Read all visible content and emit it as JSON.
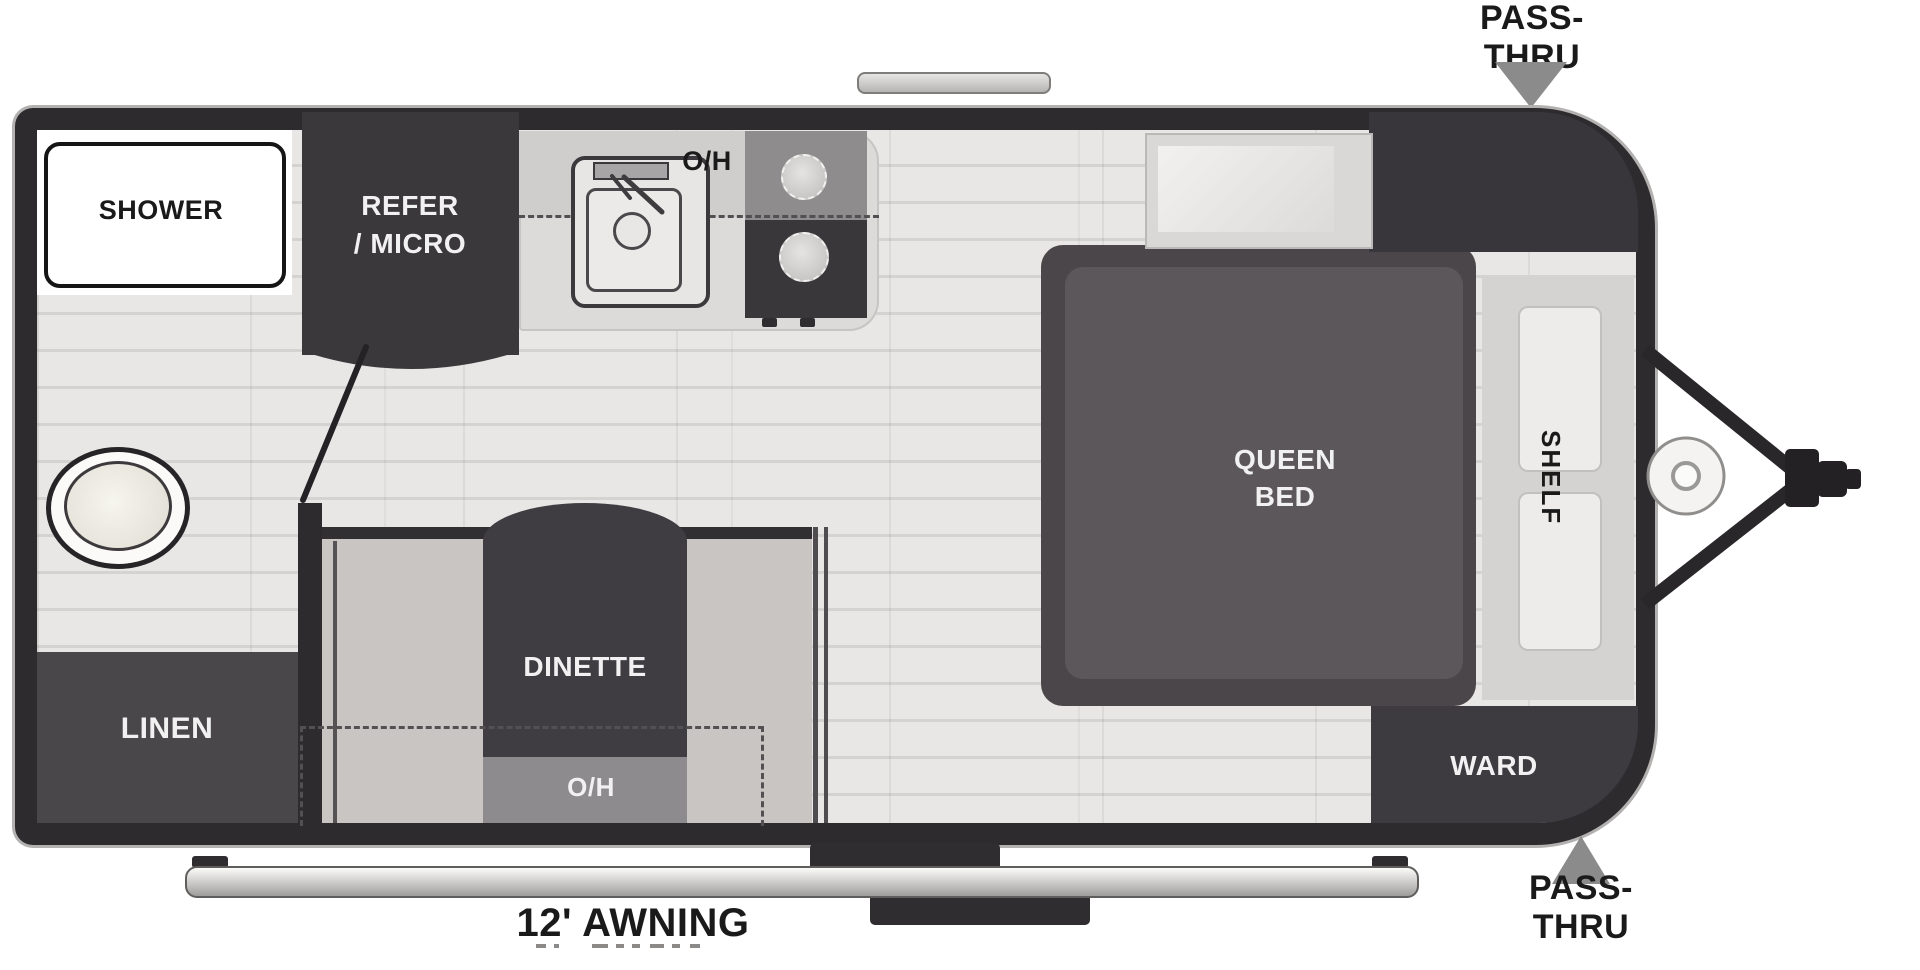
{
  "title": "Travel trailer floor plan",
  "exterior": {
    "pass_thru_top": "PASS-THRU",
    "pass_thru_bottom": "PASS-THRU",
    "awning": "12' AWNING"
  },
  "rooms": {
    "bathroom": {
      "shower": "SHOWER",
      "linen": "LINEN"
    },
    "kitchen": {
      "refer_line1": "REFER",
      "refer_line2": "/ MICRO",
      "overhead": "O/H"
    },
    "dinette": {
      "label": "DINETTE",
      "overhead": "O/H"
    },
    "bedroom": {
      "bed_line1": "QUEEN",
      "bed_line2": "BED",
      "shelf": "SHELF",
      "ward": "WARD"
    }
  },
  "colors": {
    "wall": "#2e2b2e",
    "floor": "#e9e7e5",
    "floor_line": "#d5d3d1",
    "dark_block": "#3b383c",
    "linen": "#4a474b",
    "ward": "#3d3a40",
    "table": "#403d42",
    "booth": "#c8c5c2",
    "counter": "#dcdbd9",
    "counter_shade": "#cfcecd",
    "stove_gray": "#8e8c8d",
    "stove_dark": "#3a373b",
    "shelf_strip": "#d5d3d1",
    "shelf_box": "#edecea",
    "platform": "#4a4649",
    "mattress": "#5c575b",
    "arrow": "#8b8b8b",
    "dash": "#525052",
    "oh_strip": "#8d8b8e",
    "text_white": "#f2f1f2",
    "text_black": "#1b1a1b"
  }
}
